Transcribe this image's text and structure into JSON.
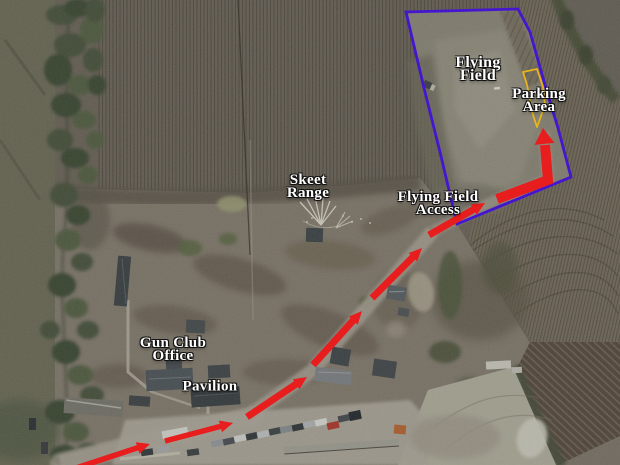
{
  "labels": {
    "flying_field": {
      "line1": "Flying",
      "line2": "Field"
    },
    "parking_area": {
      "line1": "Parking",
      "line2": "Area"
    },
    "skeet_range": {
      "line1": "Skeet",
      "line2": "Range"
    },
    "flying_field_access": {
      "line1": "Flying Field",
      "line2": "Access"
    },
    "gun_club_office": {
      "line1": "Gun Club",
      "line2": "Office"
    },
    "pavilion": {
      "line1": "Pavilion"
    }
  },
  "colors": {
    "field_boundary": "#4416d0",
    "parking_outline": "#e8b31c",
    "route": "#e81d1d",
    "label_text": "#ffffff"
  }
}
